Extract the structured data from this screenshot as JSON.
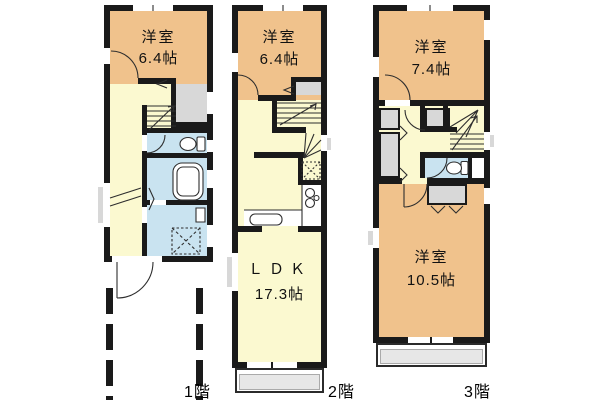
{
  "floorplan": {
    "floors": [
      {
        "label": "1階",
        "rooms": [
          {
            "name": "洋室",
            "area": "6.4帖"
          }
        ]
      },
      {
        "label": "2階",
        "rooms": [
          {
            "name": "洋室",
            "area": "6.4帖"
          },
          {
            "name": "ＬＤＫ",
            "area": "17.3帖"
          }
        ]
      },
      {
        "label": "3階",
        "rooms": [
          {
            "name": "洋室",
            "area": "7.4帖"
          },
          {
            "name": "洋室",
            "area": "10.5帖"
          }
        ]
      }
    ],
    "colors": {
      "wall": "#1a1a1a",
      "room": "#f0c28c",
      "hall": "#fbf9d0",
      "wet": "#c9e3f0",
      "closet": "#d8d8d8",
      "balcony": "#e7e7e7",
      "background": "#ffffff"
    },
    "icons": {
      "stairs": "stairs-icon",
      "toilet": "toilet-icon",
      "bathtub": "bathtub-icon",
      "washing_machine": "washing-machine-icon",
      "stove": "stove-icon",
      "kitchen_sink": "kitchen-sink-icon",
      "refrigerator": "refrigerator-icon",
      "entrance_door": "door-swing-icon",
      "parking": "parking-dashed-lines"
    }
  }
}
